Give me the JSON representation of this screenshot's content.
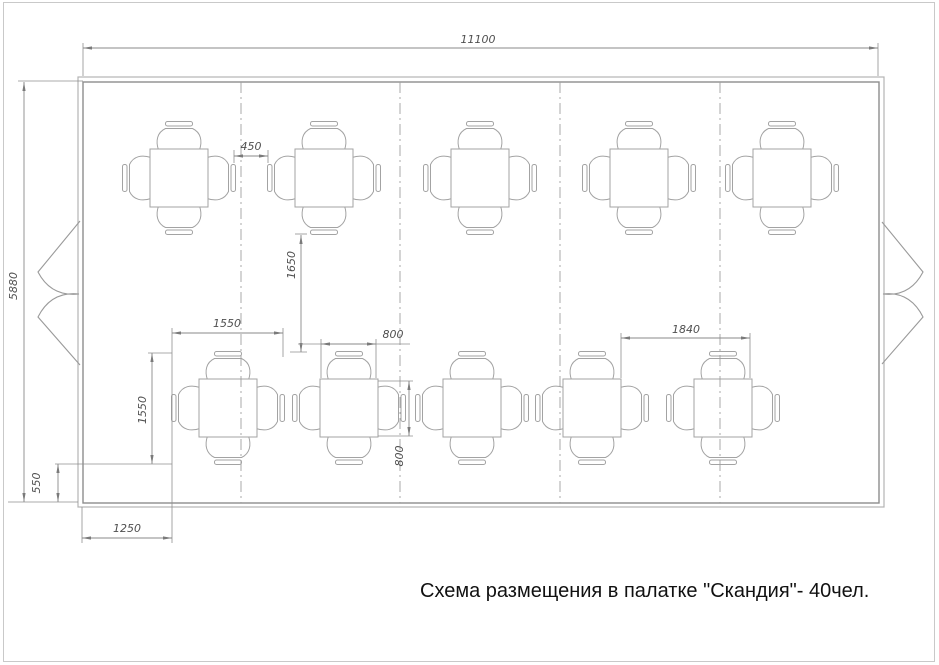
{
  "title": {
    "text": "Схема размещения в палатке \"Скандия\"- 40чел."
  },
  "colors": {
    "background": "#ffffff",
    "frame": "#c9c9c9",
    "wall": "#8d8d8d",
    "furniture": "#a3a3a3",
    "dimension": "#8a8a8a",
    "dimension_text": "#4f4f4f",
    "title_text": "#111111"
  },
  "drawing": {
    "width": 939,
    "height": 665,
    "frame": {
      "x": 3.5,
      "y": 2.5,
      "w": 931,
      "h": 659
    },
    "tent": {
      "outer": {
        "x": 78,
        "y": 77,
        "w": 806,
        "h": 430
      },
      "inner": {
        "x": 83,
        "y": 82,
        "w": 796,
        "h": 421
      }
    },
    "dividers": {
      "xs": [
        241,
        400,
        560,
        720
      ],
      "y1": 82,
      "y2": 503
    },
    "doors": {
      "left": [
        "M 80 221 L 38 272 Q 51 297 79 294",
        "M 80 365 L 38 317 Q 51 291 79 294"
      ],
      "right": [
        "M 882 222 L 923 272 Q 910 297 883 294",
        "M 882 364 L 923 317 Q 910 291 883 294"
      ]
    },
    "tables": {
      "half_size": 29,
      "positions": [
        {
          "cx": 179,
          "cy": 178
        },
        {
          "cx": 324,
          "cy": 178
        },
        {
          "cx": 480,
          "cy": 178
        },
        {
          "cx": 639,
          "cy": 178
        },
        {
          "cx": 782,
          "cy": 178
        },
        {
          "cx": 228,
          "cy": 408
        },
        {
          "cx": 349,
          "cy": 408
        },
        {
          "cx": 472,
          "cy": 408
        },
        {
          "cx": 592,
          "cy": 408
        },
        {
          "cx": 723,
          "cy": 408
        }
      ]
    },
    "dimensions": [
      {
        "label": "11100",
        "dir": "h",
        "y": 48,
        "x1": 83,
        "x2": 878,
        "text": {
          "x": 478,
          "y": 40,
          "rot": 0
        },
        "ext": [
          [
            83,
            43,
            83,
            76
          ],
          [
            878,
            43,
            878,
            76
          ]
        ]
      },
      {
        "label": "5880",
        "dir": "v",
        "x": 24,
        "y1": 82,
        "y2": 502,
        "text": {
          "x": 14,
          "y": 286,
          "rot": -90
        },
        "ext": [
          [
            18,
            81,
            83,
            81
          ],
          [
            8,
            502,
            78,
            502
          ]
        ]
      },
      {
        "label": "450",
        "dir": "h",
        "y": 156,
        "x1": 234,
        "x2": 268,
        "text": {
          "x": 251,
          "y": 147,
          "rot": 0
        },
        "ext": [
          [
            234,
            150,
            234,
            163
          ],
          [
            268,
            150,
            268,
            163
          ]
        ]
      },
      {
        "label": "1650",
        "dir": "v",
        "x": 301,
        "y1": 235,
        "y2": 352,
        "text": {
          "x": 292,
          "y": 265,
          "rot": -90
        },
        "ext": [
          [
            295,
            234,
            307,
            234
          ],
          [
            290,
            352,
            307,
            352
          ]
        ]
      },
      {
        "label": "1550",
        "dir": "h",
        "y": 333,
        "x1": 172,
        "x2": 283,
        "text": {
          "x": 227,
          "y": 324,
          "rot": 0
        },
        "ext": [
          [
            172,
            328,
            172,
            543
          ],
          [
            283,
            328,
            283,
            357
          ]
        ]
      },
      {
        "label": "1550",
        "dir": "v",
        "x": 152,
        "y1": 353,
        "y2": 464,
        "text": {
          "x": 143,
          "y": 410,
          "rot": -90
        },
        "ext": [
          [
            148,
            353,
            172,
            353
          ]
        ]
      },
      {
        "label": "800",
        "dir": "h",
        "y": 344,
        "x1": 321,
        "x2": 376,
        "text": {
          "x": 393,
          "y": 335,
          "rot": 0
        },
        "ext": [
          [
            321,
            339,
            321,
            378
          ],
          [
            376,
            339,
            376,
            378
          ],
          [
            298,
            344,
            321,
            344
          ],
          [
            376,
            344,
            410,
            344
          ]
        ]
      },
      {
        "label": "800",
        "dir": "v",
        "x": 409,
        "y1": 381,
        "y2": 436,
        "text": {
          "x": 400,
          "y": 456,
          "rot": -90
        },
        "ext": [
          [
            378,
            381,
            413,
            381
          ],
          [
            378,
            436,
            413,
            436
          ]
        ]
      },
      {
        "label": "1840",
        "dir": "h",
        "y": 338,
        "x1": 621,
        "x2": 750,
        "text": {
          "x": 686,
          "y": 330,
          "rot": 0
        },
        "ext": [
          [
            621,
            333,
            621,
            378
          ],
          [
            750,
            333,
            750,
            378
          ]
        ]
      },
      {
        "label": "1250",
        "dir": "h",
        "y": 538,
        "x1": 82,
        "x2": 172,
        "text": {
          "x": 127,
          "y": 529,
          "rot": 0
        },
        "ext": [
          [
            82,
            507,
            82,
            543
          ]
        ]
      },
      {
        "label": "550",
        "dir": "v",
        "x": 58,
        "y1": 464,
        "y2": 502,
        "text": {
          "x": 37,
          "y": 483,
          "rot": -90
        },
        "ext": [
          [
            55,
            464,
            172,
            464
          ]
        ]
      }
    ]
  }
}
